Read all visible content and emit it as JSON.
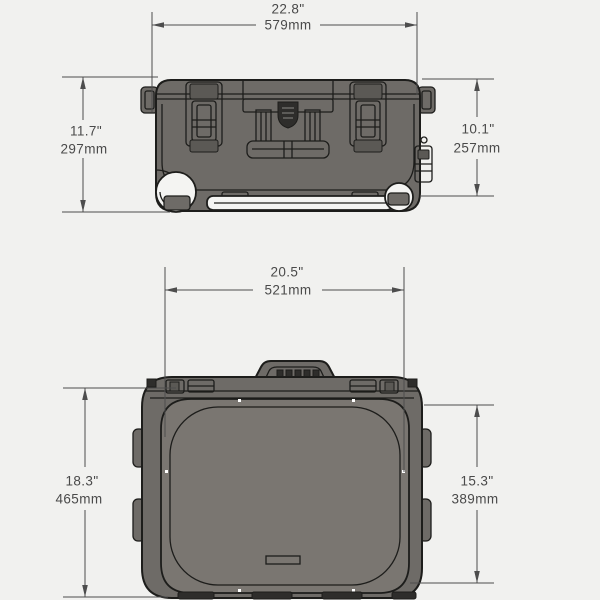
{
  "colors": {
    "background": "#f1f1ef",
    "case_fill": "#6e6b67",
    "lid_fill": "#7a7671",
    "outline": "#1d1d1b",
    "dimension": "#4d4d4d",
    "text": "#4a4a4a",
    "emblem": "#2e2d2b",
    "shade": "#5b5955",
    "white_detail": "#f4f4f2"
  },
  "views": {
    "front": {
      "width": {
        "inches": "22.8\"",
        "mm": "579mm"
      },
      "height_left": {
        "inches": "11.7\"",
        "mm": "297mm"
      },
      "height_right": {
        "inches": "10.1\"",
        "mm": "257mm"
      }
    },
    "top": {
      "width": {
        "inches": "20.5\"",
        "mm": "521mm"
      },
      "depth_left": {
        "inches": "18.3\"",
        "mm": "465mm"
      },
      "depth_right": {
        "inches": "15.3\"",
        "mm": "389mm"
      }
    }
  }
}
